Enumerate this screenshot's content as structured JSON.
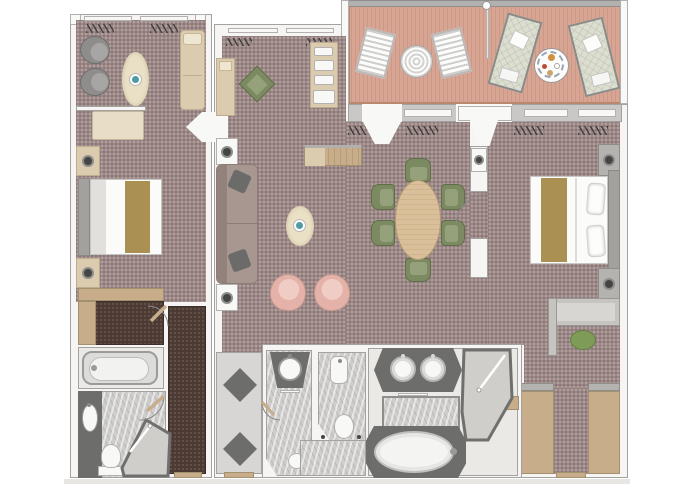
{
  "palette": {
    "wall": "#f6f5f3",
    "wall_line": "#a3a2a0",
    "carpet": "#9c8887",
    "carpet_dot_light": "#b7a5a4",
    "carpet_dot_dark": "#877372",
    "carpet_dark": "#4c3b34",
    "carpet_dark_dot": "#6b564b",
    "deck": "#d8a593",
    "deck_gap": "#cc9887",
    "deck_frame": "#b9896f",
    "rail": "#b2b1af",
    "band": "#c9c8c6",
    "marble": "#cecdcb",
    "floor_light": "#ebe9e6",
    "entry_floor": "#d8d6d4",
    "counter_dark": "#6d6d6b",
    "fixture": "#f8f8f6",
    "fixture_line": "#b3b1af",
    "wood": "#c8ad8b",
    "wood_light": "#dbcbaf",
    "cream": "#e8dec8",
    "gold": "#ab9054",
    "gray_chair": "#8e8d8b",
    "sofa": "#a89690",
    "sofa_dark": "#93817b",
    "pillow": "#6b6b69",
    "green": "#7b8a60",
    "green_dark": "#5f6e48",
    "green_light": "#95a17b",
    "stool": "#7f9b58",
    "pink": "#e4b2a8",
    "pink_light": "#f0cdc4",
    "rug": "#eae0c6",
    "teal": "#4f9aa4",
    "headboard": "#a3a19d",
    "gray_furn": "#b5b3b0",
    "lamp": "#454543",
    "lounger": "#dcded0",
    "plate_rim": "#9aa4b5",
    "food_orange": "#d29041",
    "food_red": "#bb4a38",
    "shadow": "#e7e6e3"
  },
  "rooms": {
    "left_suite": [
      "sitting-area",
      "bedroom",
      "walk-in-closet",
      "bathtub-room",
      "bathroom",
      "entry-corridor"
    ],
    "right_suite": [
      "living-room",
      "dining-area",
      "master-bedroom",
      "walk-in-wardrobe",
      "master-bathroom",
      "powder-room",
      "wc",
      "entry-hall"
    ],
    "balcony_sections": [
      "veranda-left",
      "veranda-right"
    ]
  },
  "furniture": {
    "left_suite": [
      "armchair",
      "armchair",
      "oval-rug-with-table",
      "chaise",
      "bench",
      "nightstand",
      "double-bed",
      "nightstand",
      "dresser",
      "wardrobe",
      "bathtub",
      "vanity-sink",
      "toilet",
      "shower"
    ],
    "right_suite": [
      "chaise",
      "accent-chair",
      "bar-cabinet",
      "media-console",
      "side-table",
      "sofa",
      "side-table",
      "oval-rug-with-table",
      "tub-chair",
      "tub-chair",
      "dining-table",
      "dining-chair-x6",
      "nightstand",
      "double-bed",
      "nightstand",
      "desk",
      "stool",
      "wardrobe",
      "wardrobe",
      "double-sink-vanity",
      "oval-bathtub",
      "shower",
      "powder-sink",
      "toilet",
      "wc-sink",
      "wc-toilet"
    ],
    "balcony": [
      "deck-chair",
      "deck-chair",
      "round-table",
      "sun-lounger",
      "sun-lounger",
      "breakfast-table"
    ]
  },
  "titles": {
    "bed_left": "double-bed",
    "bed_right": "double-bed",
    "sofa": "sofa",
    "dining_table": "dining-table",
    "tub_left": "bathtub",
    "tub_right": "oval-bathtub",
    "vanity": "double-sink-vanity",
    "desk": "desk",
    "balcony": "private-veranda",
    "lounger": "sun-lounger",
    "deck_chair": "deck-chair",
    "rug": "oval-rug"
  }
}
